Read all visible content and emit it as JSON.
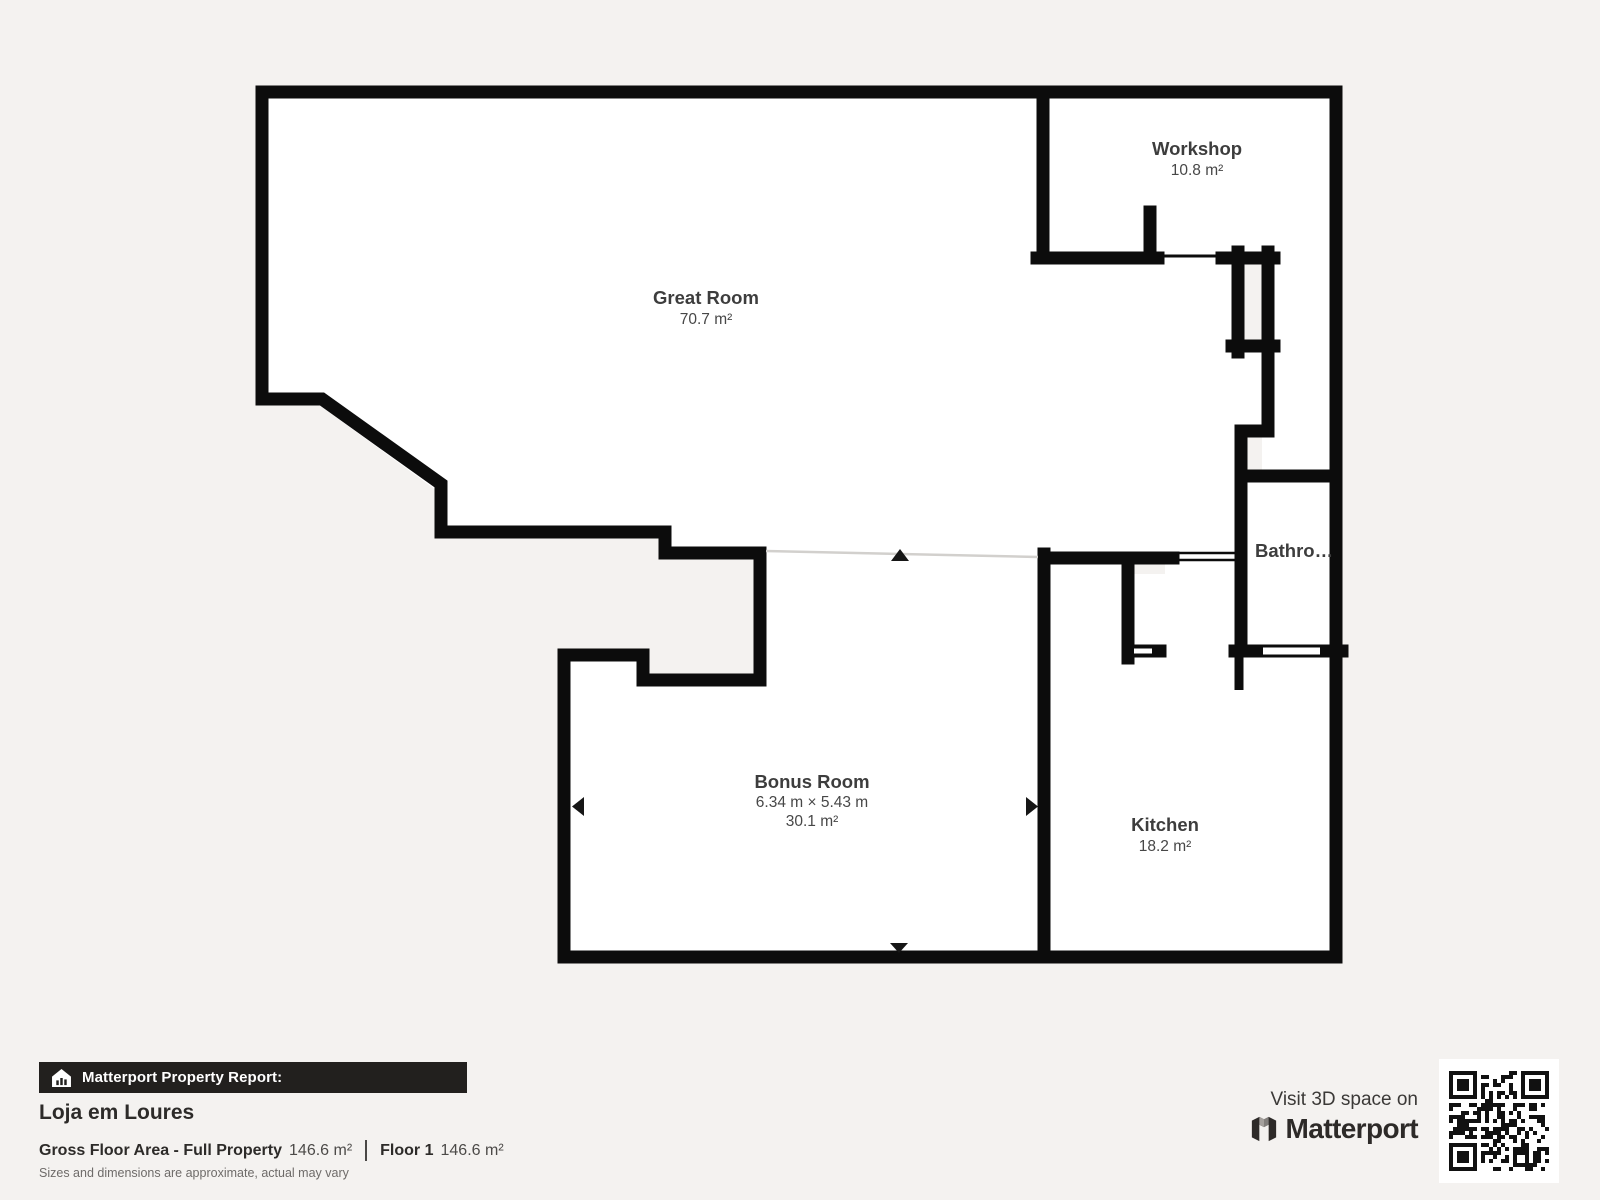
{
  "plan": {
    "rooms": {
      "great_room": {
        "name": "Great Room",
        "area": "70.7 m²"
      },
      "workshop": {
        "name": "Workshop",
        "area": "10.8 m²"
      },
      "bathroom": {
        "name": "Bathro…"
      },
      "bonus_room": {
        "name": "Bonus Room",
        "dimensions": "6.34 m × 5.43 m",
        "area": "30.1 m²"
      },
      "kitchen": {
        "name": "Kitchen",
        "area": "18.2 m²"
      }
    }
  },
  "footer": {
    "badge": "Matterport Property Report:",
    "property_name": "Loja em Loures",
    "area_label": "Gross Floor Area - Full Property",
    "area_value": "146.6 m²",
    "floor_label": "Floor 1",
    "floor_value": "146.6 m²",
    "disclaimer": "Sizes and dimensions are approximate, actual may vary"
  },
  "cta": {
    "visit_label": "Visit 3D space on",
    "brand": "Matterport",
    "qr_icon": "qr-code"
  },
  "colors": {
    "background": "#f4f2f0",
    "wall": "#0c0c0c",
    "room_fill": "#ffffff",
    "label_text": "#3d3d3d",
    "badge_bg": "#22201e"
  }
}
